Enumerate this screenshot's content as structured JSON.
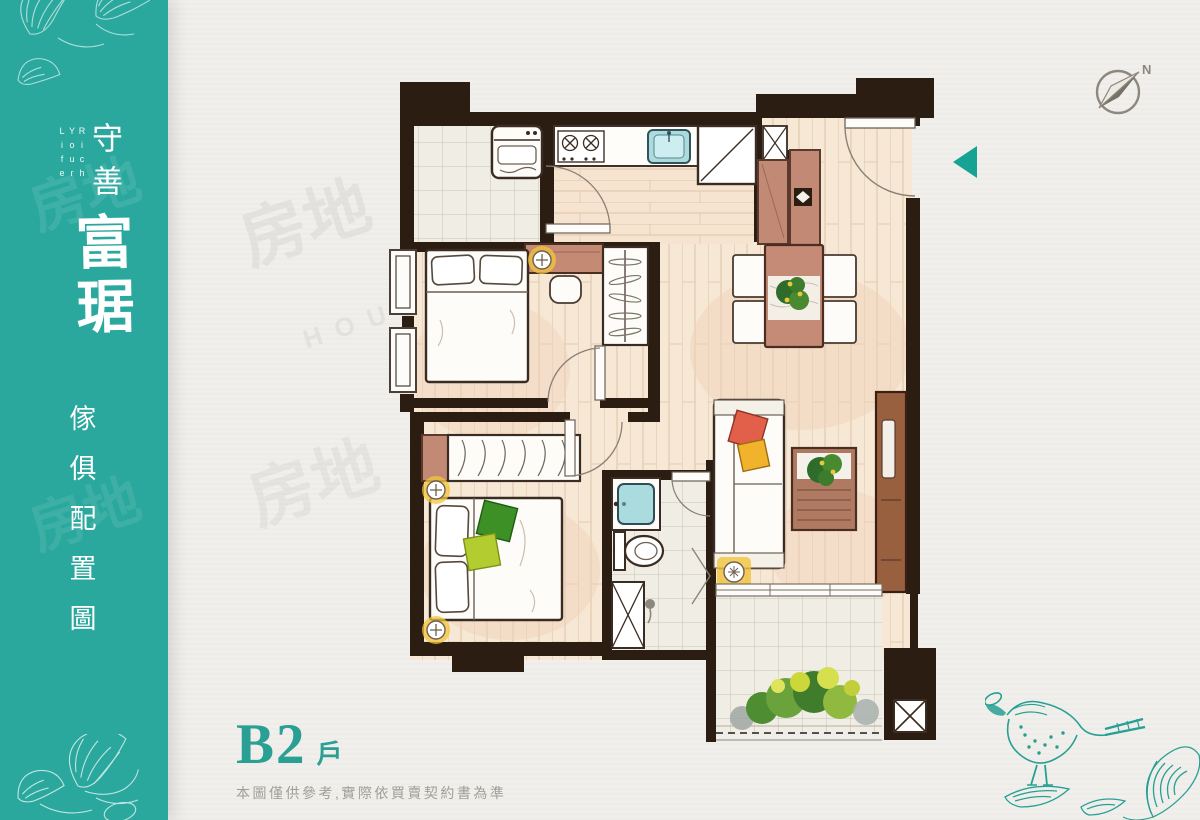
{
  "sidebar": {
    "tagline": "Rich Your Life",
    "brand_top": "守善",
    "brand_main": "富琚",
    "caption_chars": [
      "傢",
      "俱",
      "配",
      "置",
      "圖"
    ],
    "accent_color": "#2aa89d"
  },
  "unit_label": {
    "unit": "B2",
    "suffix": "戶",
    "disclaimer": "本圖僅供參考,實際依買賣契約書為準"
  },
  "compass": {
    "label": "N"
  },
  "watermark": {
    "cjk": "房地",
    "latin": "HOUSE"
  },
  "colors": {
    "sidebar_teal": "#2aa89d",
    "marker_teal": "#17a393",
    "label_teal": "#29a093",
    "disclaimer_gray": "#a09e98",
    "wall_dark": "#2c1d13",
    "wood_floor": "#f7e7d5",
    "wood_furniture": "#c28a75",
    "tile": "#f0ede4",
    "water_fixture": "#a9dbdf",
    "paper": "#f1efec",
    "plant_green": "#3f7d2c",
    "pillow_red": "#e2604a",
    "pillow_yellow": "#f2b32c",
    "light_glow": "#f4c53a"
  }
}
